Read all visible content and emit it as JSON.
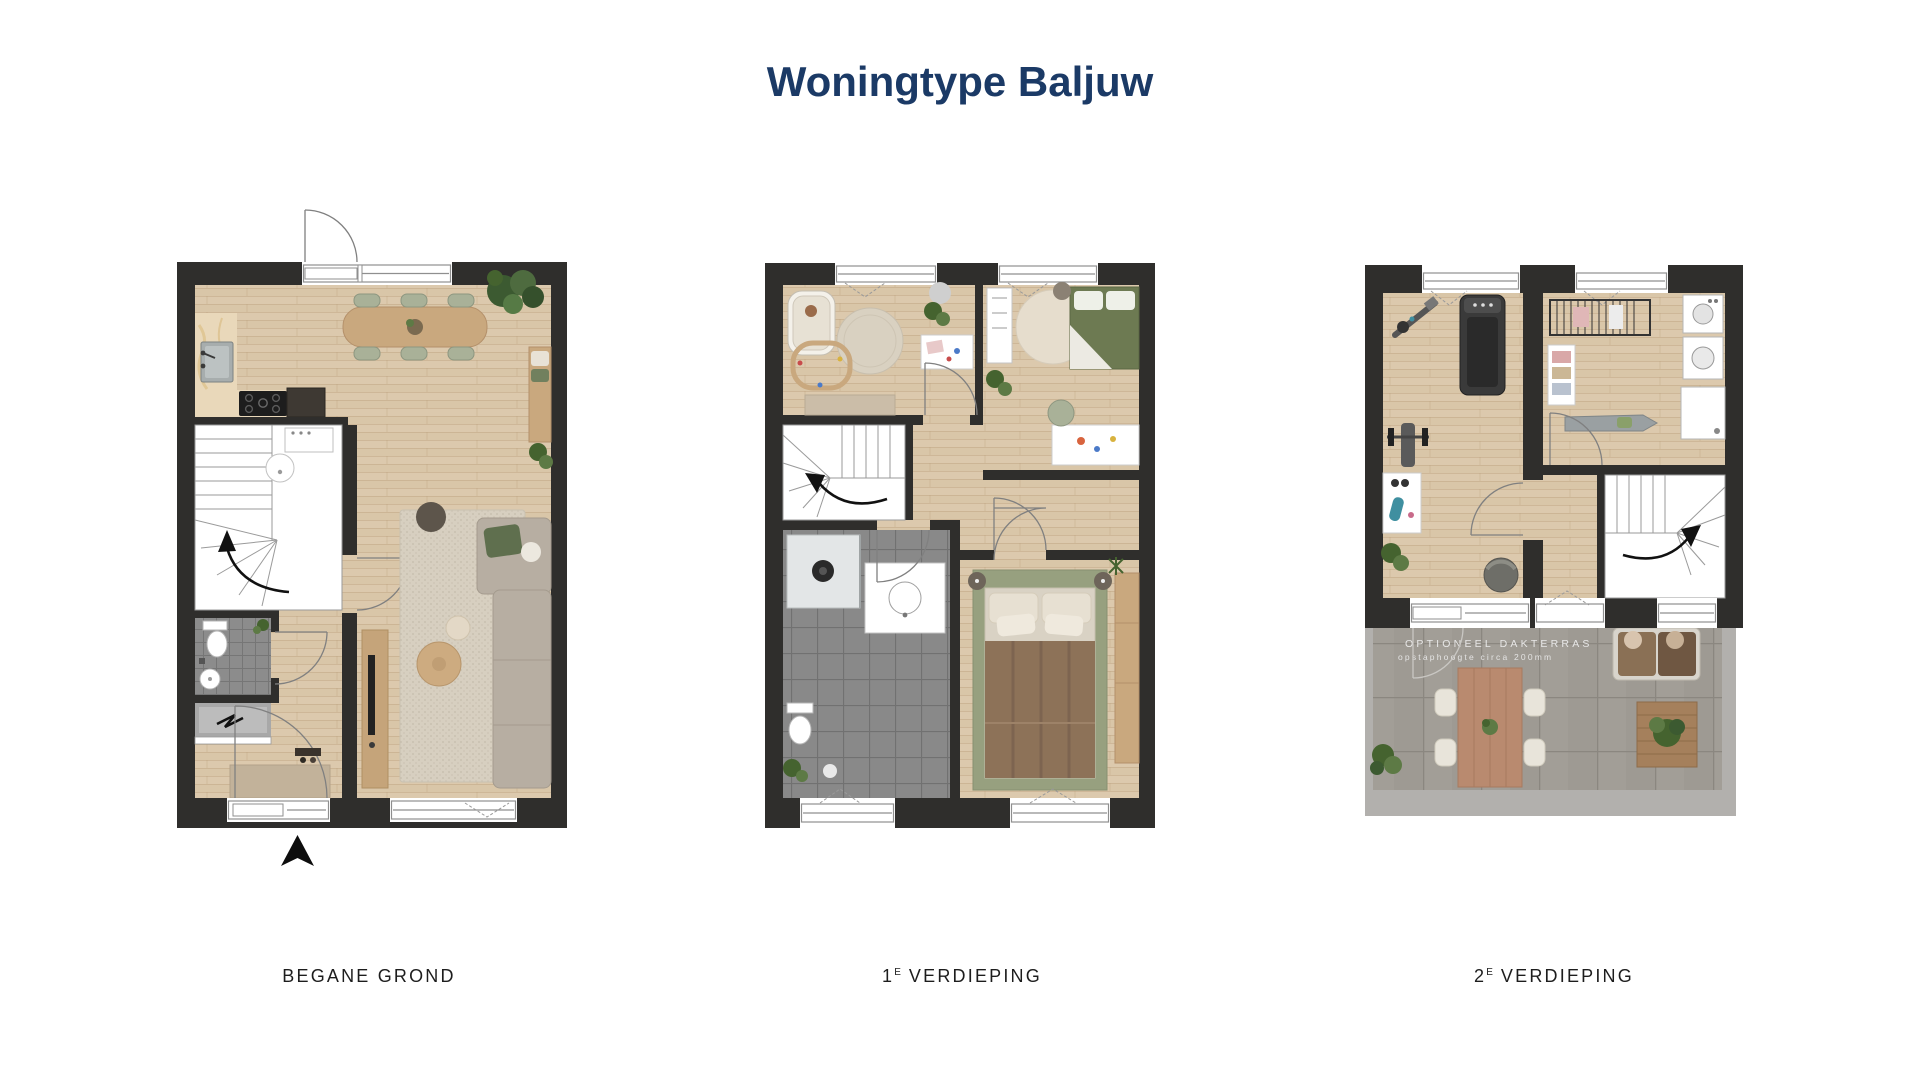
{
  "title": "Woningtype Baljuw",
  "floors": [
    {
      "name": "begane-grond",
      "label_pre": "BEGANE GROND",
      "label_sup": "",
      "label_post": ""
    },
    {
      "name": "eerste-verdieping",
      "label_pre": "1",
      "label_sup": "E",
      "label_post": "VERDIEPING"
    },
    {
      "name": "tweede-verdieping",
      "label_pre": "2",
      "label_sup": "E",
      "label_post": "VERDIEPING"
    }
  ],
  "terrace_note": {
    "line1": "OPTIONEEL DAKTERRAS",
    "line2": "opstaphoogte circa 200mm"
  },
  "colors": {
    "title_navy": "#1b3a66",
    "wall_charcoal": "#2f2e2c",
    "wood_floor": "#dcc9ad",
    "bath_tile_gray": "#8c8c8c",
    "terrace_tile_gray": "#9e9a93",
    "sage_green": "#a9b198",
    "plant_green": "#45632f",
    "label_black": "#1d1d1d"
  }
}
